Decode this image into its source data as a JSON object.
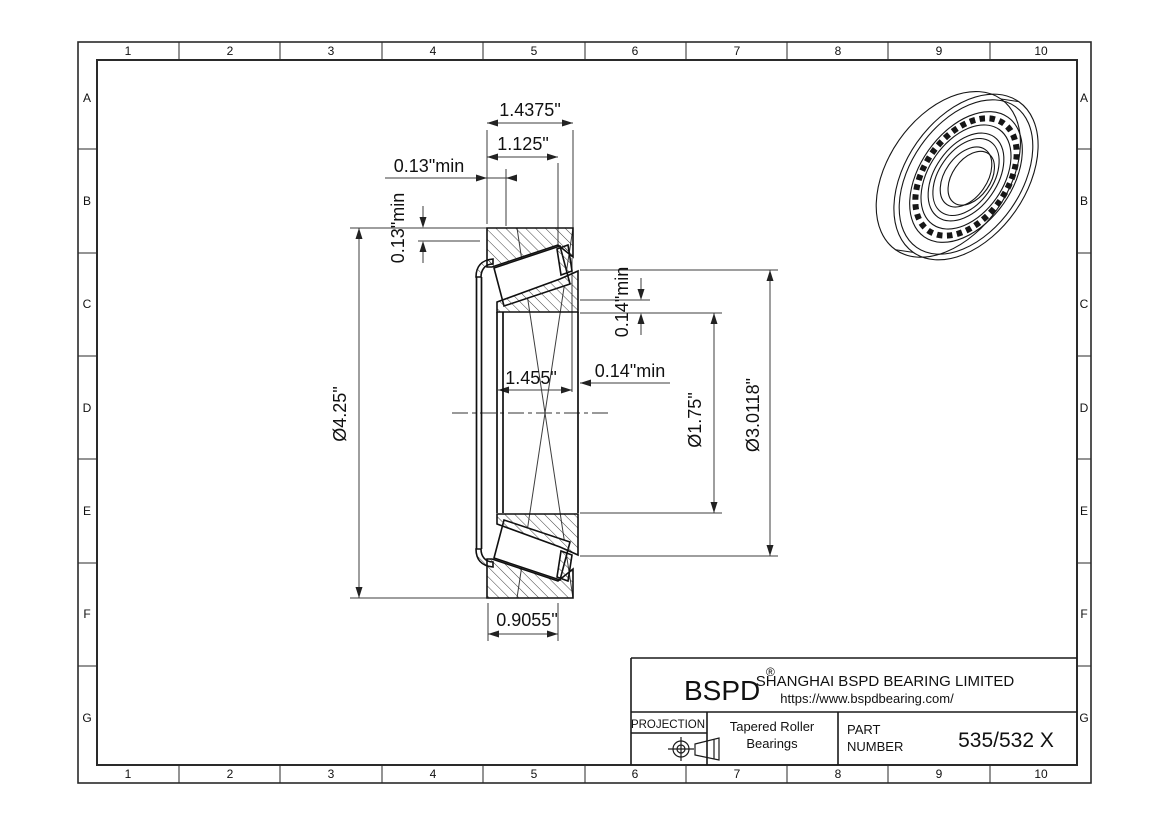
{
  "border": {
    "columns": [
      "1",
      "2",
      "3",
      "4",
      "5",
      "6",
      "7",
      "8",
      "9",
      "10"
    ],
    "rows": [
      "A",
      "B",
      "C",
      "D",
      "E",
      "F",
      "G"
    ]
  },
  "drawing": {
    "dims": {
      "overall_width": "1.4375\"",
      "cone_width": "1.125\"",
      "front_clearance_axial": "0.13\"min",
      "front_clearance_radial": "0.13\"min",
      "back_clearance_radial": "0.14\"min",
      "back_clearance_axial": "0.14\"min",
      "inner_width": "1.455\"",
      "outer_diameter": "Ø4.25\"",
      "bore_diameter": "Ø1.75\"",
      "cone_backface_diameter": "Ø3.0118\"",
      "cup_width": "0.9055\""
    }
  },
  "title_block": {
    "logo": "BSPD",
    "registered": "®",
    "company": "SHANGHAI BSPD BEARING LIMITED",
    "website": "https://www.bspdbearing.com/",
    "projection_label": "PROJECTION",
    "product_line1": "Tapered Roller",
    "product_line2": "Bearings",
    "part_label_line1": "PART",
    "part_label_line2": "NUMBER",
    "part_number": "535/532 X"
  }
}
